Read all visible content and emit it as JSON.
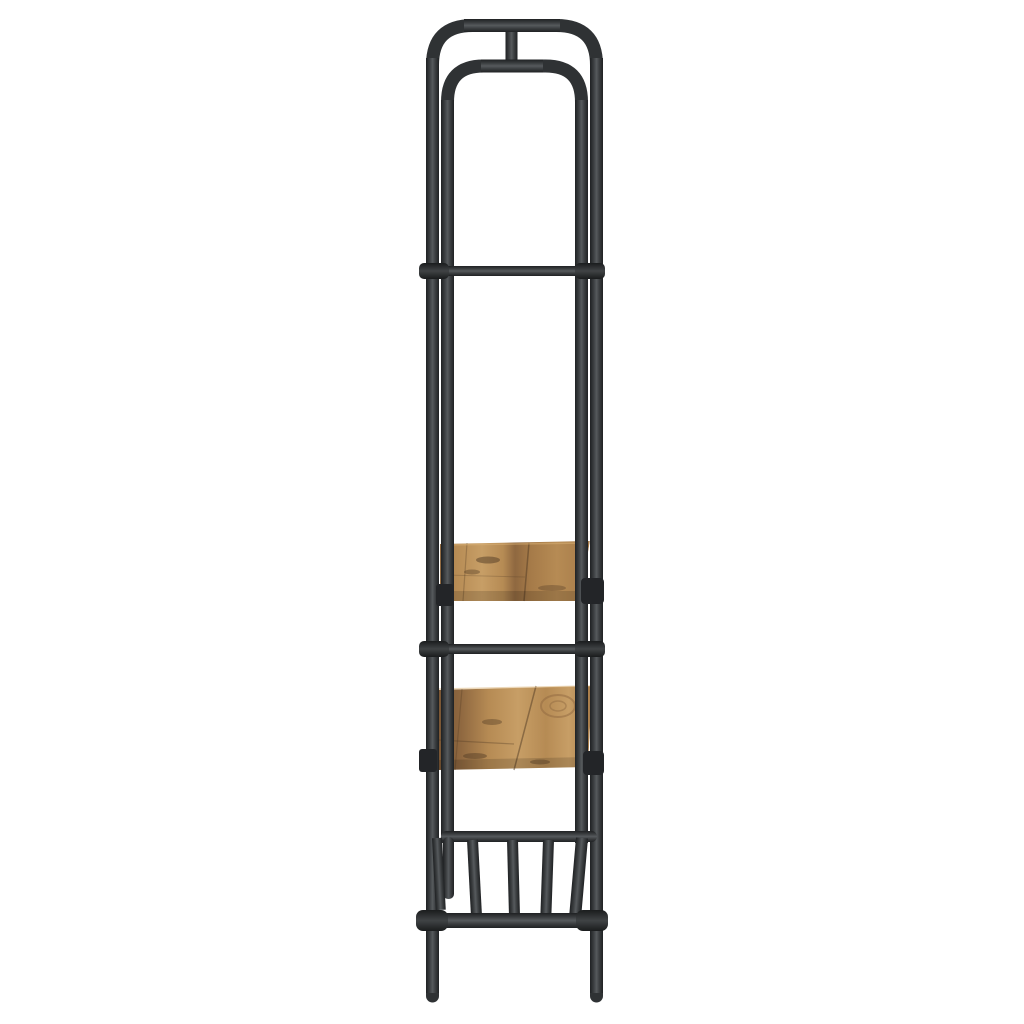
{
  "meta": {
    "description": "Product photo: side profile view of a tall narrow black metal clothes rack with rounded arch frame, two rustic brown wooden shelves, a slatted bottom shoe shelf and tube feet, on a plain white background",
    "background": "#ffffff"
  },
  "palette": {
    "background": "#ffffff",
    "frame_edge": "#1f2123",
    "frame_mid": "#3b3e40",
    "frame_highlight": "#565a5d",
    "frame_flat": "#2f3234",
    "fitting_dark": "#1a1c1d",
    "fitting_mid": "#404345",
    "bracket": "#232528",
    "wood_light": "#c79e66",
    "wood_tan": "#b68b54",
    "wood_mid": "#a57a48",
    "wood_brown": "#8f6840",
    "wood_dark": "#7a5634",
    "wood_streak": "#503a24",
    "wood_highlight": "#dab277",
    "shadow": "#000000"
  },
  "components": {
    "outer_frame": "tall outer arch frame with rounded top and tube feet",
    "inner_frame": "inner arch frame nested inside the outer frame",
    "top_connector": "short center stub joining outer and inner arch tops",
    "upper_crossbar": "upper horizontal crossbar with collar fittings",
    "middle_crossbar": "middle horizontal crossbar with collar fittings",
    "upper_shelf": "upper rustic wooden shelf clamped with black brackets",
    "lower_shelf": "lower rustic wooden shelf clamped with black brackets",
    "slat_shelf": "bottom slatted tube shelf (shoe rack) seen from the side",
    "base_bar": "bottom horizontal support bar with collar fittings",
    "feet": "rounded tube feet"
  }
}
